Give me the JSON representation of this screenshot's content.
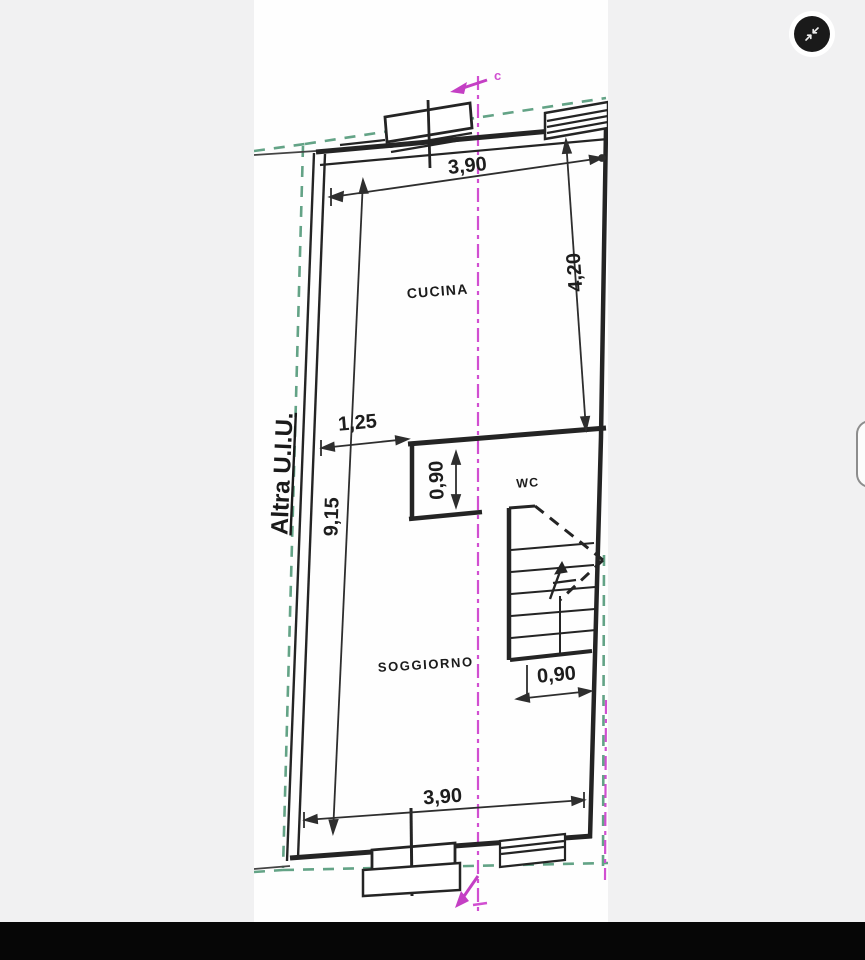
{
  "viewer": {
    "collapse_button": {
      "icon": "collapse-arrows-icon"
    },
    "bottom_bar_color": "#060606",
    "background_color": "#f1f1f2"
  },
  "plan": {
    "rooms": {
      "kitchen": "CUCINA",
      "wc": "WC",
      "living": "SOGGIORNO"
    },
    "boundary_label": "Altra U.I.U.",
    "section_mark": "c",
    "dims": {
      "top_width": "3,90",
      "kitchen_depth": "4,20",
      "opening": "1,25",
      "niche": "0,90",
      "length": "9,15",
      "stair": "0,90",
      "bottom_width": "3,90"
    },
    "colors": {
      "boundary": "#63a386",
      "section": "#d14fd1",
      "wall": "#242424"
    }
  }
}
